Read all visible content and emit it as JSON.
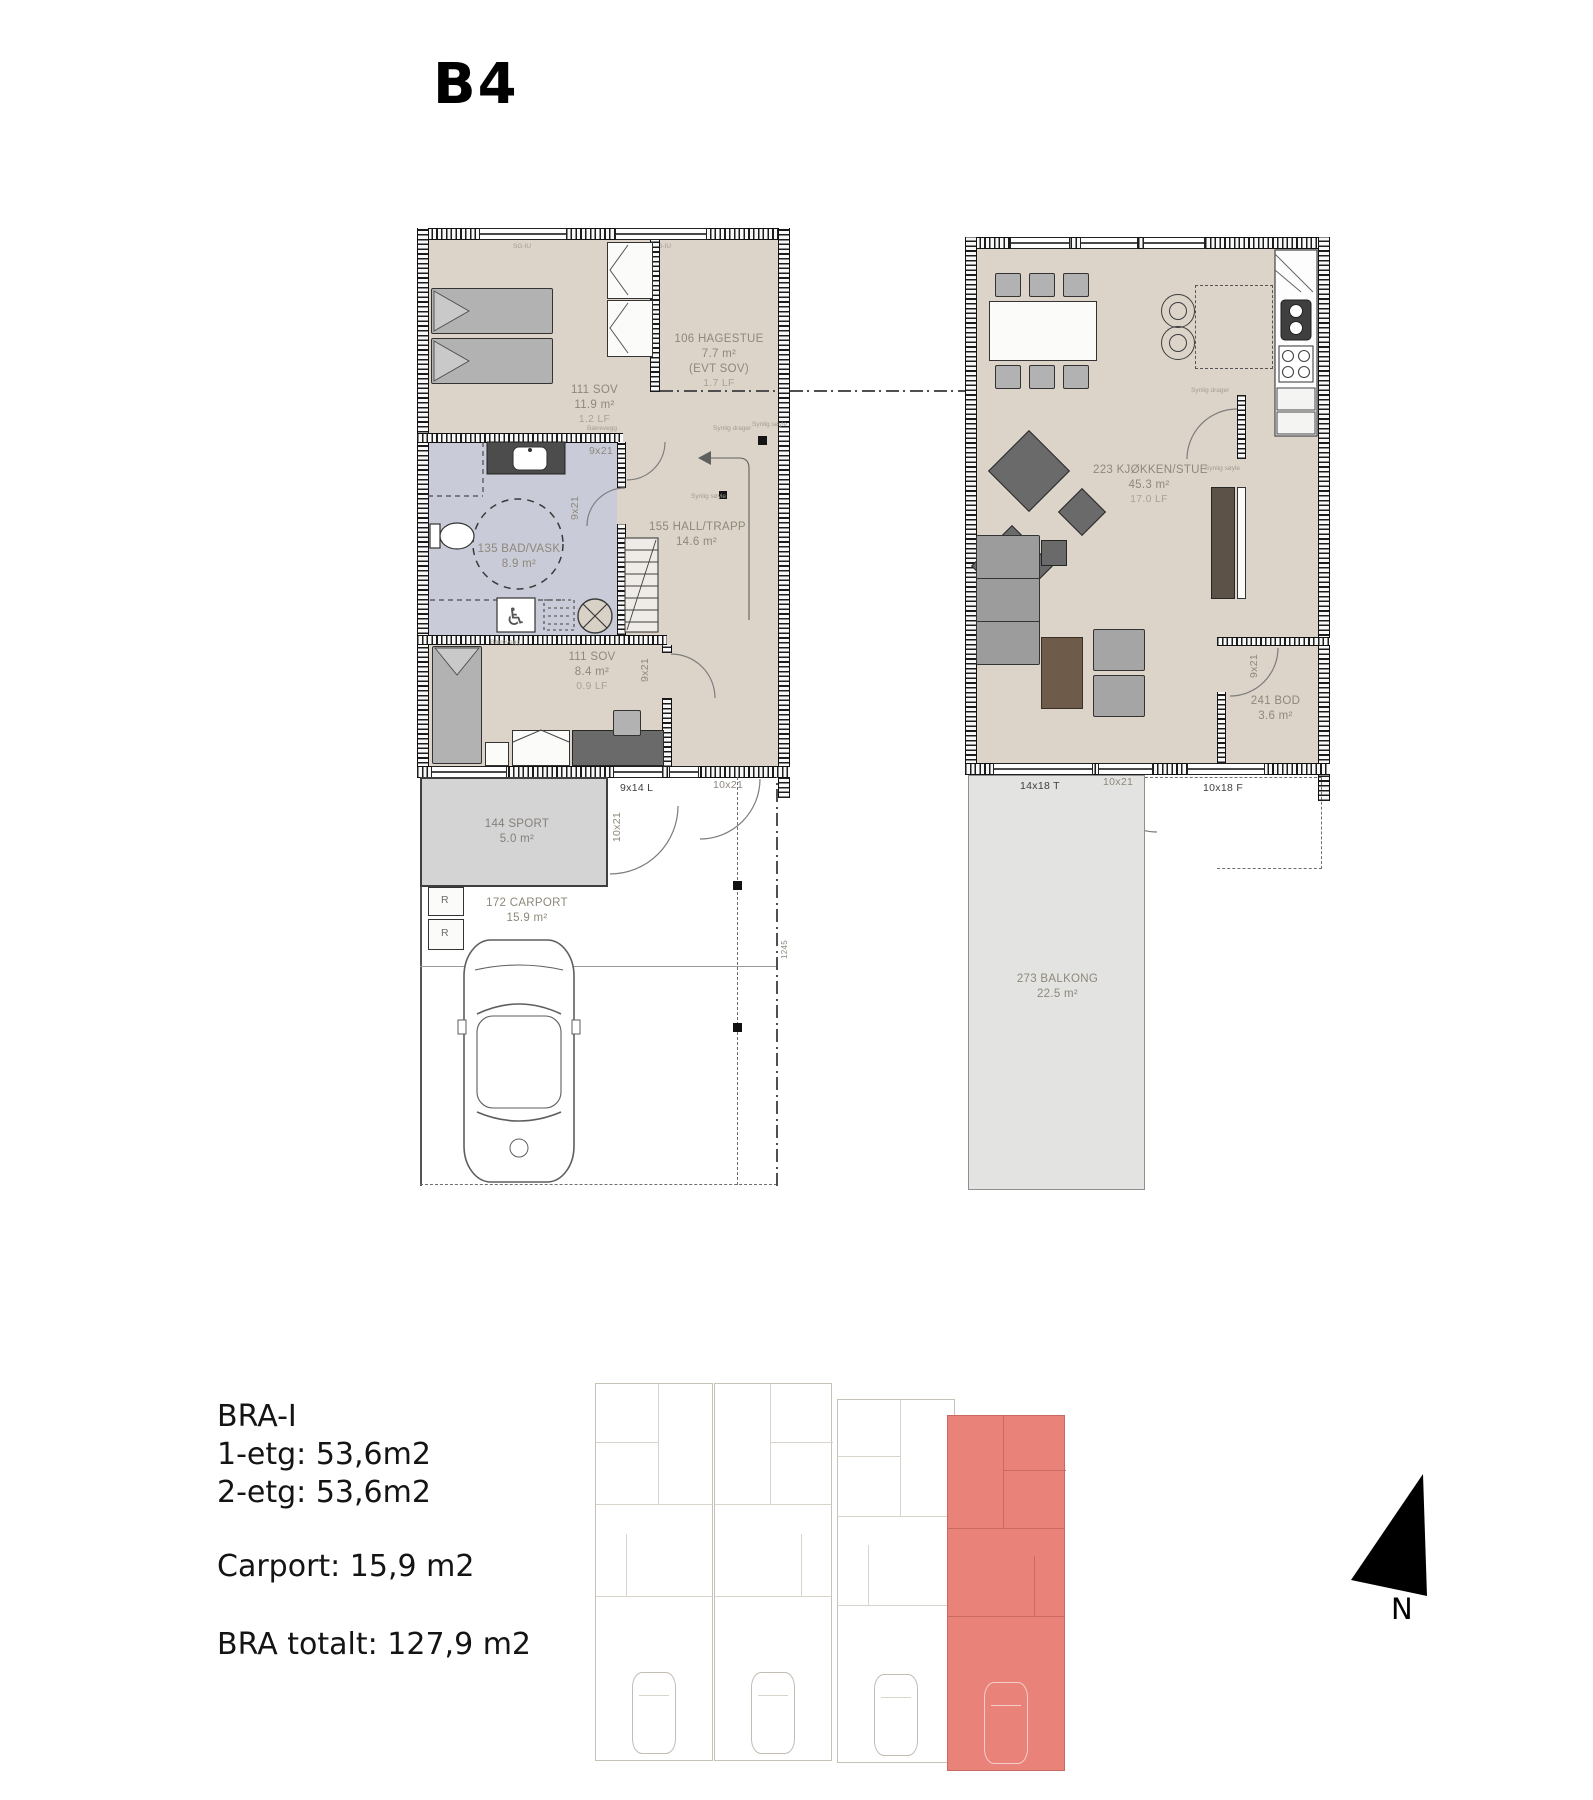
{
  "title": "B4",
  "notes": {
    "barevegg": "Bærevegg",
    "synlig_drager": "Synlig drager",
    "synlig_soyle": "Synlig søyle",
    "window_head": "SG-IU"
  },
  "floor1": {
    "sov1": {
      "name": "111 SOV",
      "area": "11.9 m²",
      "lf": "1.2  LF"
    },
    "hagestue": {
      "name": "106 HAGESTUE",
      "area": "7.7 m²",
      "alt": "(EVT SOV)",
      "lf": "1.7  LF"
    },
    "bad": {
      "name": "135 BAD/VASK",
      "area": "8.9 m²"
    },
    "hall": {
      "name": "155 HALL/TRAPP",
      "area": "14.6 m²"
    },
    "sov2": {
      "name": "111 SOV",
      "area": "8.4 m²",
      "lf": "0.9  LF"
    },
    "sport": {
      "name": "144 SPORT",
      "area": "5.0 m²"
    },
    "carport": {
      "name": "172 CARPORT",
      "area": "15.9 m²"
    },
    "door_sov1": "9x21",
    "door_bad": "9x21",
    "door_sov2": "9x21",
    "door_sport": "10x21",
    "door_entry": "10x21",
    "window_sport": "9x14 L",
    "bin": "R",
    "dim": "1245"
  },
  "floor2": {
    "stue": {
      "name": "223 KJØKKEN/STUE",
      "area": "45.3 m²",
      "lf": "17.0  LF"
    },
    "bod": {
      "name": "241 BOD",
      "area": "3.6 m²"
    },
    "balkong": {
      "name": "273 BALKONG",
      "area": "22.5 m²"
    },
    "door_bod": "9x21",
    "window_left": "14x18 T",
    "door_balcony": "10x21",
    "window_right": "10x18 F"
  },
  "summary": {
    "heading": "BRA-I",
    "etg1": "1-etg: 53,6m2",
    "etg2": "2-etg: 53,6m2",
    "carport": "Carport: 15,9 m2",
    "total": "BRA totalt: 127,9 m2"
  },
  "compass": {
    "label": "N"
  },
  "colors": {
    "floor_beige": "#dcd4c9",
    "bath_blue": "#c9ccd8",
    "balcony_grey": "#e3e3e2",
    "highlight_red": "#e98379"
  }
}
